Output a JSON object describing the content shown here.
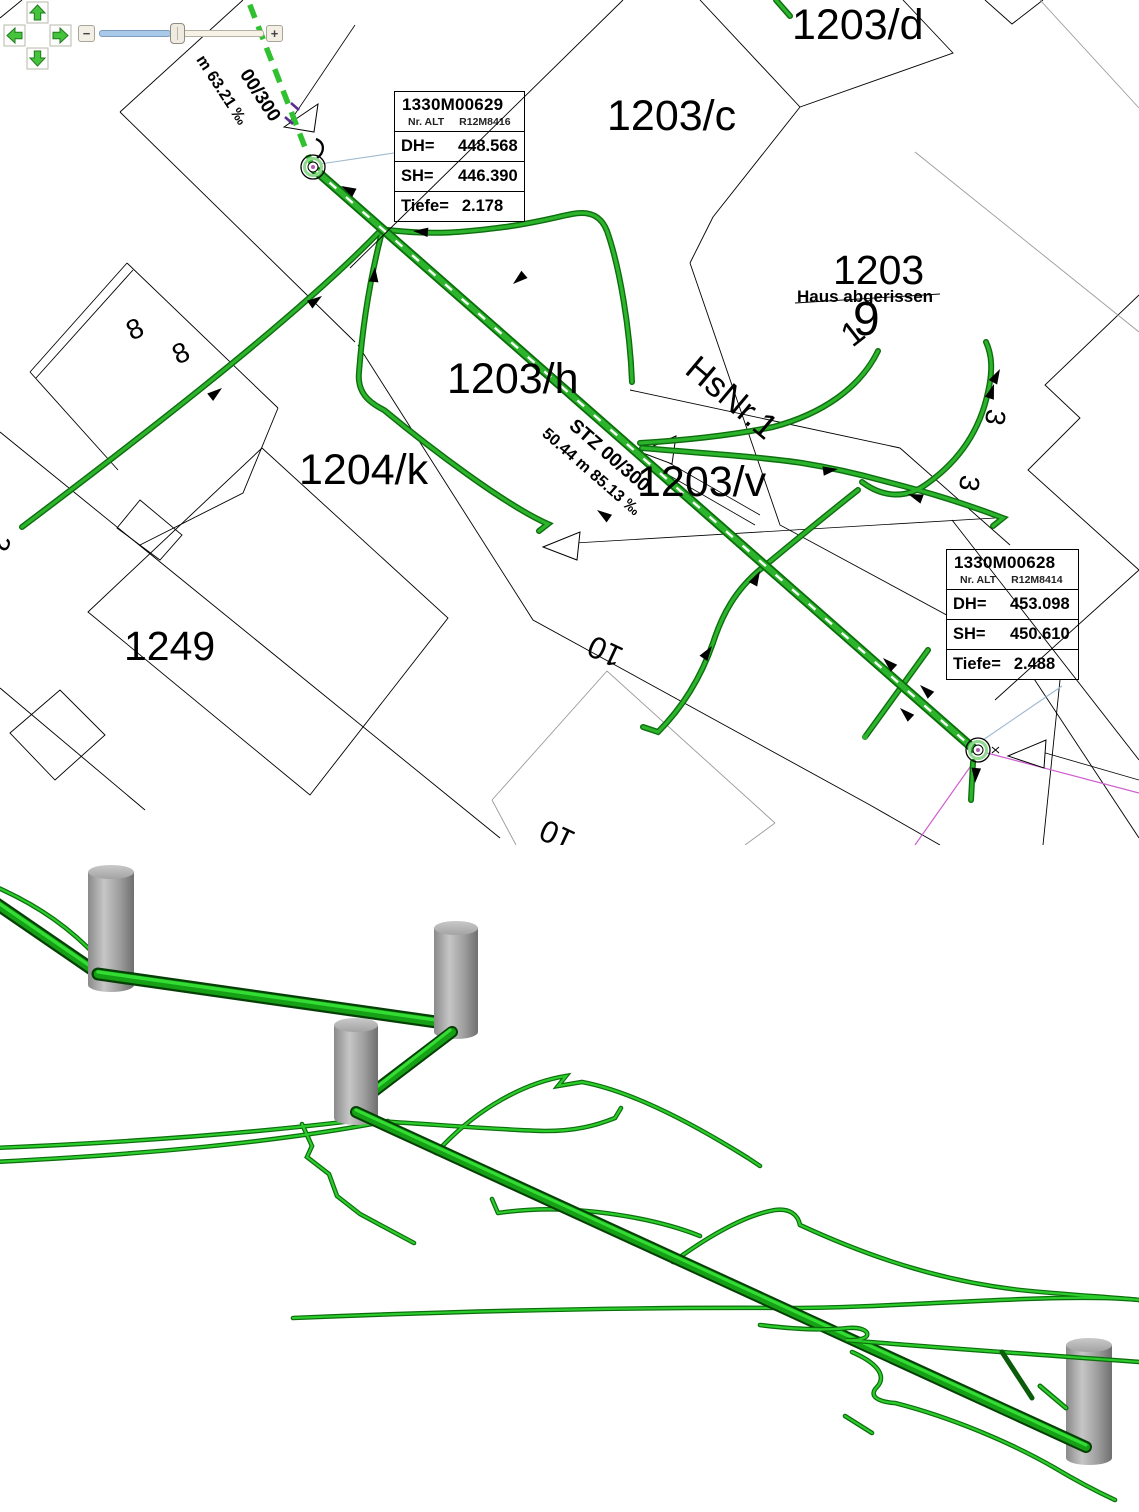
{
  "window": {
    "background": "#ffffff"
  },
  "toolbar": {
    "pan_control": {
      "up_icon": "pan-up-arrow",
      "left_icon": "pan-left-arrow",
      "right_icon": "pan-right-arrow",
      "down_icon": "pan-down-arrow"
    },
    "zoom_slider": {
      "zoom_out_label": "−",
      "zoom_in_label": "+"
    }
  },
  "map": {
    "labels": [
      {
        "text": "1203/d"
      },
      {
        "text": "1203/c"
      },
      {
        "text": "1203"
      },
      {
        "text": "Haus abgerissen"
      },
      {
        "text": "9"
      },
      {
        "text": "1"
      },
      {
        "text": "HsNr.1"
      },
      {
        "text": "1203/h"
      },
      {
        "text": "1204/k"
      },
      {
        "text": "1203/v"
      },
      {
        "text": "1249"
      },
      {
        "text": "8"
      },
      {
        "text": "8"
      },
      {
        "text": "3"
      },
      {
        "text": "3"
      },
      {
        "text": "10"
      },
      {
        "text": "10"
      },
      {
        "text": "2"
      },
      {
        "text": "0.50 ‰"
      }
    ],
    "pipe_labels": {
      "nw_dim_line1": "00/300",
      "nw_dim_line2": "m 63.21 ‰",
      "center_dim_line1": "STZ 00/300",
      "center_dim_line2": "50.44 m 85.13 ‰"
    },
    "info_boxes": [
      {
        "id": "1330M00629",
        "nr_alt_label": "Nr. ALT",
        "nr_alt_value": "R12M8416",
        "dh_label": "DH=",
        "dh_value": "448.568",
        "sh_label": "SH=",
        "sh_value": "446.390",
        "tiefe_label": "Tiefe=",
        "tiefe_value": "2.178"
      },
      {
        "id": "1330M00628",
        "nr_alt_label": "Nr. ALT",
        "nr_alt_value": "R12M8414",
        "dh_label": "DH=",
        "dh_value": "453.098",
        "sh_label": "SH=",
        "sh_value": "450.610",
        "tiefe_label": "Tiefe=",
        "tiefe_value": "2.488"
      }
    ]
  },
  "view3d": {
    "content": "3d-pipe-network-scene"
  },
  "colors": {
    "pipe_dark": "#0d6e0d",
    "pipe_bright": "#2db42d",
    "magenta_line": "#cf5fcf",
    "reference_blue": "#9fb8cf",
    "slider_fill": "#a9c9e8",
    "cylinder_gray": "#9a9a9a"
  }
}
